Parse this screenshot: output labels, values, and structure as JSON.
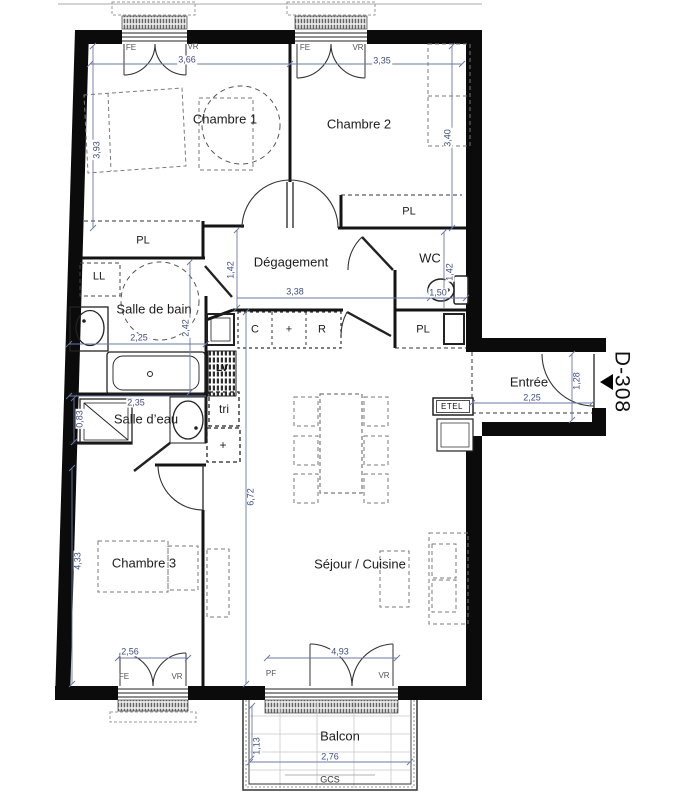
{
  "unit": {
    "id": "D-308"
  },
  "rooms": {
    "chambre1": "Chambre 1",
    "chambre2": "Chambre 2",
    "chambre3": "Chambre 3",
    "degagement": "Dégagement",
    "wc": "WC",
    "salle_de_bain": "Salle de bain",
    "salle_deau": "Salle d’eau",
    "sejour_cuisine": "Séjour / Cuisine",
    "entree": "Entrée",
    "balcon": "Balcon"
  },
  "fixtures": {
    "placard": "PL",
    "lave_linge": "LL",
    "lave_vaisselle": "LV",
    "tri": "tri",
    "plus": "+",
    "cuisson": "C",
    "refrigerateur": "R",
    "etel": "ETEL",
    "gcs": "GCS"
  },
  "windows": {
    "fe": "FE",
    "vr": "VR",
    "pf": "PF"
  },
  "dims": {
    "ch1_width": "3,66",
    "ch2_width": "3,35",
    "ch1_depth": "3,93",
    "ch2_depth": "3,40",
    "degagement_depth": "1,42",
    "degagement_width": "3,38",
    "wc_depth": "1,42",
    "wc_width": "1,50",
    "sdb_width": "2,25",
    "sdb_depth": "2,42",
    "sde_width": "2,35",
    "sde_depth": "0,83",
    "entree_width": "2,25",
    "entree_depth": "1,28",
    "ch3_depth": "4,33",
    "sejour_depth": "6,72",
    "ch3_width": "2,56",
    "sejour_width": "4,93",
    "balcon_width": "2,76",
    "balcon_depth": "1,13"
  }
}
